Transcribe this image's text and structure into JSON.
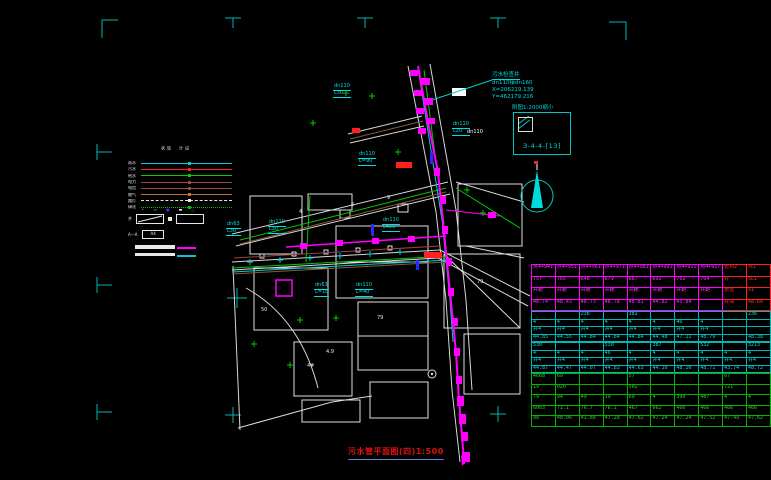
{
  "drawing": {
    "title": "污水管平面图(四)1:500",
    "index_note": "附图1:2000缩小",
    "index_sheet": "3-4-4-[13]",
    "coord_block": {
      "line1": "污水检查井",
      "line2": "dn110接dn160",
      "line3": "X=206219.139",
      "line4": "Y=462179.216"
    }
  },
  "legend": {
    "col_existing": "现状",
    "col_design": "设计",
    "rows": [
      {
        "label": "雨水",
        "color": "#00d0d0",
        "style": "solid"
      },
      {
        "label": "污水",
        "color": "#ff2020",
        "style": "solid"
      },
      {
        "label": "给水",
        "color": "#00d000",
        "style": "solid"
      },
      {
        "label": "电力",
        "color": "#a04848",
        "style": "solid"
      },
      {
        "label": "电信",
        "color": "#905040",
        "style": "solid"
      },
      {
        "label": "燃气",
        "color": "#b87838",
        "style": "solid"
      },
      {
        "label": "路灯",
        "color": "#e8e8e8",
        "style": "dashed"
      },
      {
        "label": "绿化",
        "color": "#00c000",
        "style": "dotted"
      }
    ],
    "symbols": [
      {
        "glyph": "+",
        "color": "#00c800"
      },
      {
        "glyph": "▬",
        "color": "#008000"
      },
      {
        "glyph": "●",
        "color": "#3838ff"
      },
      {
        "glyph": "▬",
        "color": "#ffffff"
      },
      {
        "glyph": "△",
        "color": "#00c800"
      }
    ],
    "well_label": "井",
    "section_label": "A—A",
    "section_box": "A4"
  },
  "map_labels": [
    {
      "lines": [
        "dn110",
        "L30"
      ],
      "x": 333,
      "y": 84,
      "color": "#00e0e0",
      "u": true
    },
    {
      "lines": [
        "dn110",
        "L=90"
      ],
      "x": 358,
      "y": 152,
      "color": "#00e0e0",
      "u": true
    },
    {
      "lines": [
        "dn110",
        "L20"
      ],
      "x": 452,
      "y": 122,
      "color": "#00e0e0",
      "u": true
    },
    {
      "lines": [
        "dn63",
        "L30"
      ],
      "x": 226,
      "y": 222,
      "color": "#00e0e0",
      "u": true
    },
    {
      "lines": [
        "dn110",
        "L30"
      ],
      "x": 268,
      "y": 220,
      "color": "#00e0e0",
      "u": true
    },
    {
      "lines": [
        "dn110",
        "L420"
      ],
      "x": 382,
      "y": 218,
      "color": "#00e0e0",
      "u": true
    },
    {
      "lines": [
        "dn63",
        "L=16"
      ],
      "x": 314,
      "y": 283,
      "color": "#00e0e0",
      "u": true
    },
    {
      "lines": [
        "dn110",
        "L=40"
      ],
      "x": 355,
      "y": 283,
      "color": "#00e0e0",
      "u": true
    },
    {
      "lines": [
        "dn110"
      ],
      "x": 466,
      "y": 130,
      "color": "#ffffff",
      "u": false
    },
    {
      "lines": [
        "4"
      ],
      "x": 298,
      "y": 210,
      "color": "#e8e8e8",
      "u": false
    },
    {
      "lines": [
        "6"
      ],
      "x": 350,
      "y": 203,
      "color": "#e8e8e8",
      "u": false
    },
    {
      "lines": [
        "9"
      ],
      "x": 386,
      "y": 196,
      "color": "#e8e8e8",
      "u": false
    },
    {
      "lines": [
        "79"
      ],
      "x": 376,
      "y": 316,
      "color": "#e8e8e8",
      "u": false
    },
    {
      "lines": [
        "4.9"
      ],
      "x": 325,
      "y": 350,
      "color": "#e8e8e8",
      "u": false
    },
    {
      "lines": [
        "50"
      ],
      "x": 260,
      "y": 308,
      "color": "#e8e8e8",
      "u": false
    },
    {
      "lines": [
        "4#"
      ],
      "x": 306,
      "y": 364,
      "color": "#e8e8e8",
      "u": false
    },
    {
      "lines": [
        "79"
      ],
      "x": 476,
      "y": 280,
      "color": "#e8e8e8",
      "u": false
    }
  ],
  "table": {
    "sections": [
      {
        "border": "#ff00ff",
        "text": "#ff30ff",
        "alt_cols": 2,
        "alt_border": "#ff2020",
        "alt_text": "#ff3030",
        "row_h": 10.5,
        "rows": [
          [
            "点4+941",
            "点4+951",
            "点4+961",
            "点4+971",
            "点4+981",
            "点4+991",
            "点4+911",
            "点4+917",
            "管材2",
            "点1"
          ],
          [
            "757",
            "765",
            "648",
            "679",
            "687",
            "692",
            "762",
            "764",
            "井",
            "5L1"
          ],
          [
            "井距",
            "井距",
            "井距",
            "井距",
            "井距",
            "井距",
            "井距",
            "井距",
            "管径",
            "51"
          ],
          [
            "48.74",
            "48.43",
            "48.73",
            "48.78",
            "48.81",
            "44.82",
            "43.84",
            "",
            "井深",
            "48.60"
          ]
        ]
      },
      {
        "border": "#00b8b8",
        "text": "#00e0e0",
        "row_h": 6.5,
        "rows": [
          [
            "",
            "",
            "236",
            "",
            "382",
            "",
            "",
            "",
            "",
            "236"
          ],
          [
            "4",
            "4",
            "4",
            "4",
            "4",
            "4",
            "46",
            "4",
            "",
            ""
          ],
          [
            "井4",
            "井4",
            "井4",
            "井4",
            "井4",
            "井4",
            "井4",
            "井4",
            "",
            ""
          ],
          [
            "44.85",
            "44.55",
            "44.84",
            "44.84",
            "44.84",
            "44.48",
            "47.11",
            "48.79",
            "",
            "48.38"
          ]
        ]
      },
      {
        "border": "#00b8b8",
        "text": "#00e0e0",
        "row_h": 6.5,
        "rows": [
          [
            "530",
            "",
            "",
            "530",
            "",
            "387",
            "",
            "532",
            "",
            "3213"
          ],
          [
            "4",
            "4",
            "4",
            "46",
            "4",
            "4",
            "4",
            "4",
            "4",
            "4"
          ],
          [
            "井4",
            "井4",
            "井4",
            "井4",
            "井4",
            "井4",
            "井4",
            "井4",
            "井4",
            "井4"
          ],
          [
            "44.87",
            "44.47",
            "44.07",
            "44.83",
            "44.63",
            "44.10",
            "48.10",
            "48.71",
            "43.74",
            "48.72"
          ]
        ]
      },
      {
        "border": "#00b400",
        "text": "#20d820",
        "row_h": 9.5,
        "rows": [
          [
            "4668",
            "69",
            "",
            "",
            "57",
            "",
            "",
            "",
            "67",
            ""
          ],
          [
            "19",
            "020",
            "",
            "",
            "502",
            "",
            "",
            "",
            "721",
            ""
          ],
          [
            "79",
            "94",
            "49",
            "19",
            "69",
            "4",
            "390",
            "487",
            "4",
            "4"
          ],
          [
            "6063",
            "71.1",
            "76.7",
            "76.1",
            "467",
            "662",
            "466",
            "466",
            "466",
            "466"
          ],
          [
            "98",
            "48.06",
            "41.88",
            "47.28",
            "47.62",
            "47.24",
            "47.24",
            "47.52",
            "47.49",
            "47.62"
          ]
        ]
      }
    ]
  }
}
